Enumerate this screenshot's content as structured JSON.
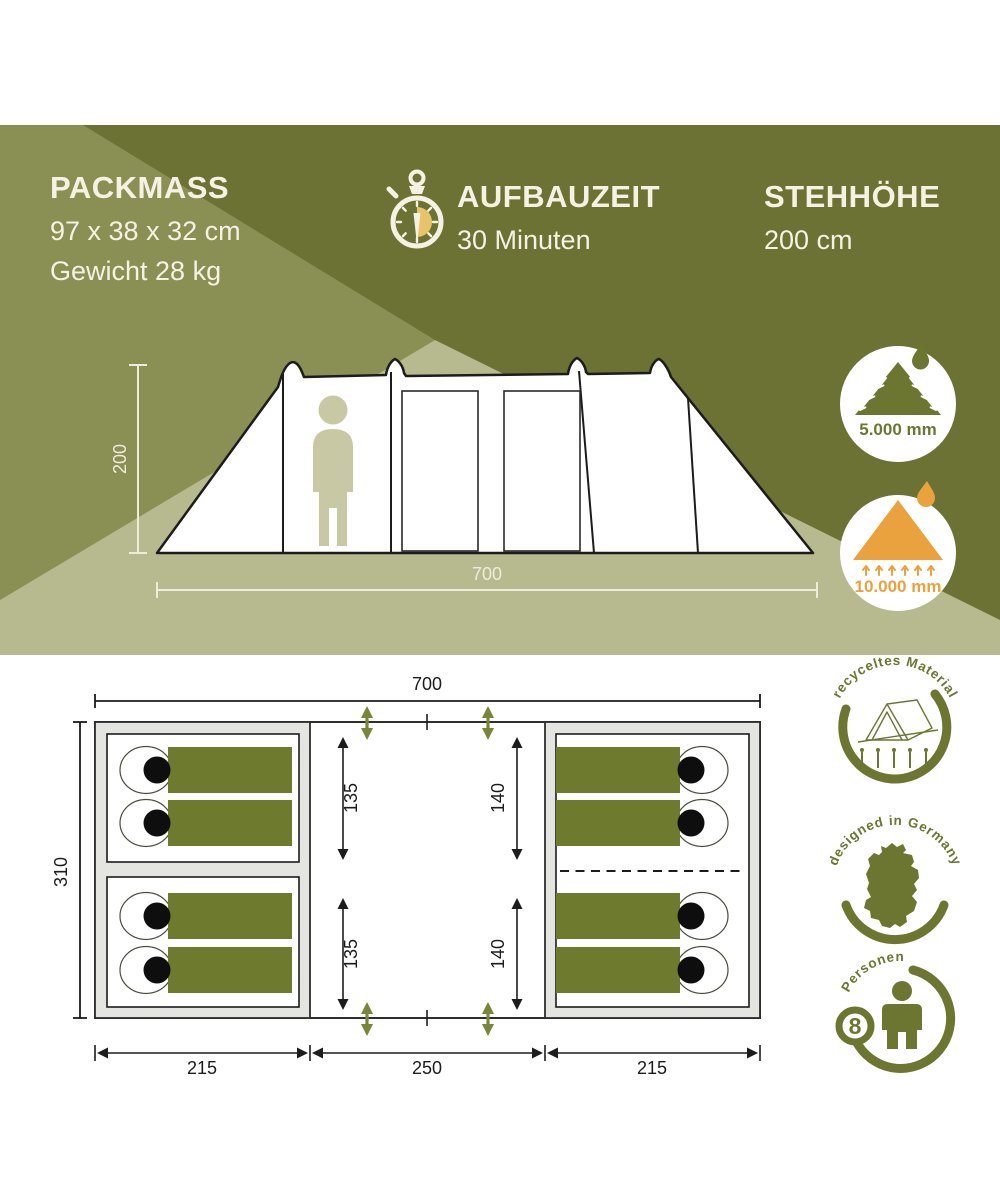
{
  "banner": {
    "packmass_title": "PACKMASS",
    "packmass_dims": "97 x 38 x 32 cm",
    "packmass_weight": "Gewicht 28 kg",
    "aufbau_title": "AUFBAUZEIT",
    "aufbau_value": "30 Minuten",
    "steh_title": "STEHHÖHE",
    "steh_value": "200 cm"
  },
  "side_view": {
    "height_cm": "200",
    "width_cm": "700",
    "flysheet_water_column": "5.000 mm",
    "groundsheet_water_column": "10.000 mm"
  },
  "floor_plan": {
    "width": "700",
    "depth": "310",
    "sections": [
      "215",
      "250",
      "215"
    ],
    "left_heights": [
      "135",
      "135"
    ],
    "right_heights": [
      "140",
      "140"
    ],
    "sleeping_bags_left": 4,
    "sleeping_bags_right": 4
  },
  "stamps": {
    "recycled": "recyceltes Material",
    "designed": "designed in Germany",
    "persons_label": "Personen",
    "persons_count": "8"
  },
  "colors": {
    "dark_olive": "#6b7233",
    "medium_olive": "#8a9054",
    "light_khaki": "#b7ba8e",
    "cream": "#f5f2e3",
    "badge_olive": "#6d7631",
    "orange": "#e9a23e",
    "bag_green": "#6e7a2e",
    "gold": "#e7c469"
  }
}
